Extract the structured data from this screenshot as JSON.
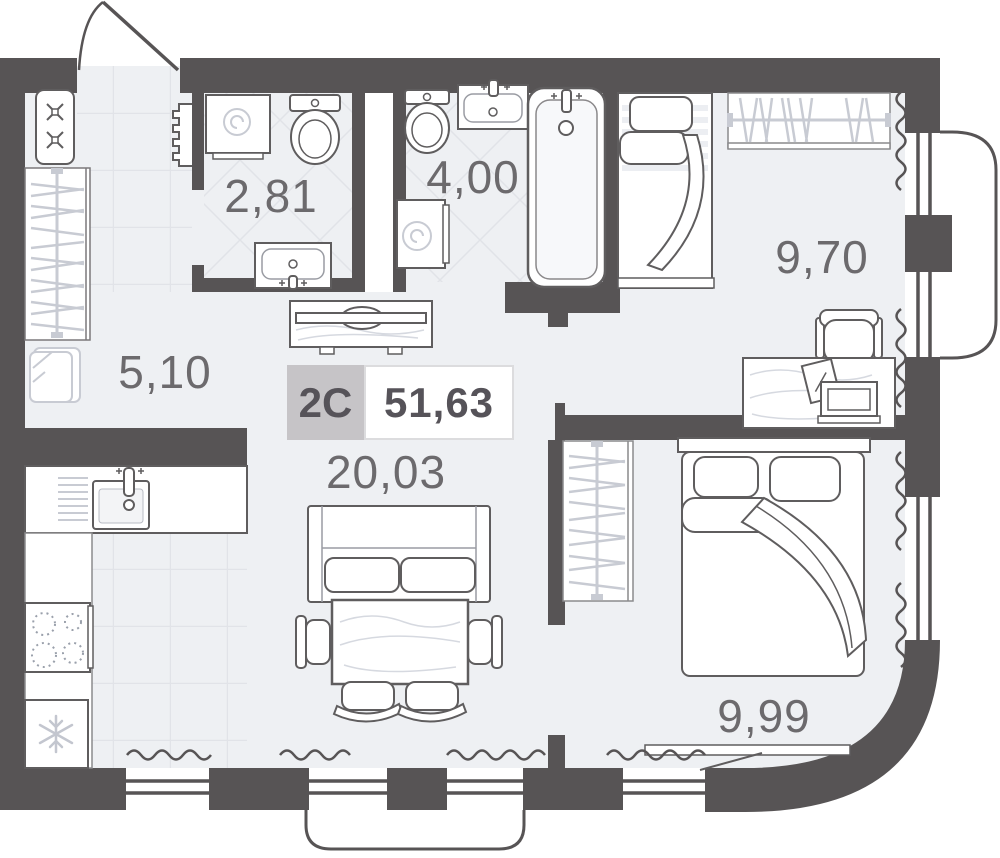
{
  "plan": {
    "apartment": {
      "type": "2C",
      "total_area": "51,63"
    },
    "rooms": [
      {
        "id": "hallway",
        "area": "5,10"
      },
      {
        "id": "bathroom-small",
        "area": "2,81"
      },
      {
        "id": "bathroom-large",
        "area": "4,00"
      },
      {
        "id": "bedroom-top",
        "area": "9,70"
      },
      {
        "id": "living-kitchen",
        "area": "20,03"
      },
      {
        "id": "bedroom-bottom",
        "area": "9,99"
      }
    ],
    "colors": {
      "wall": "#575455",
      "floor": "#eef0f3",
      "badge_bg": "#c6c4c7",
      "label_text": "#6c6a6d"
    }
  }
}
